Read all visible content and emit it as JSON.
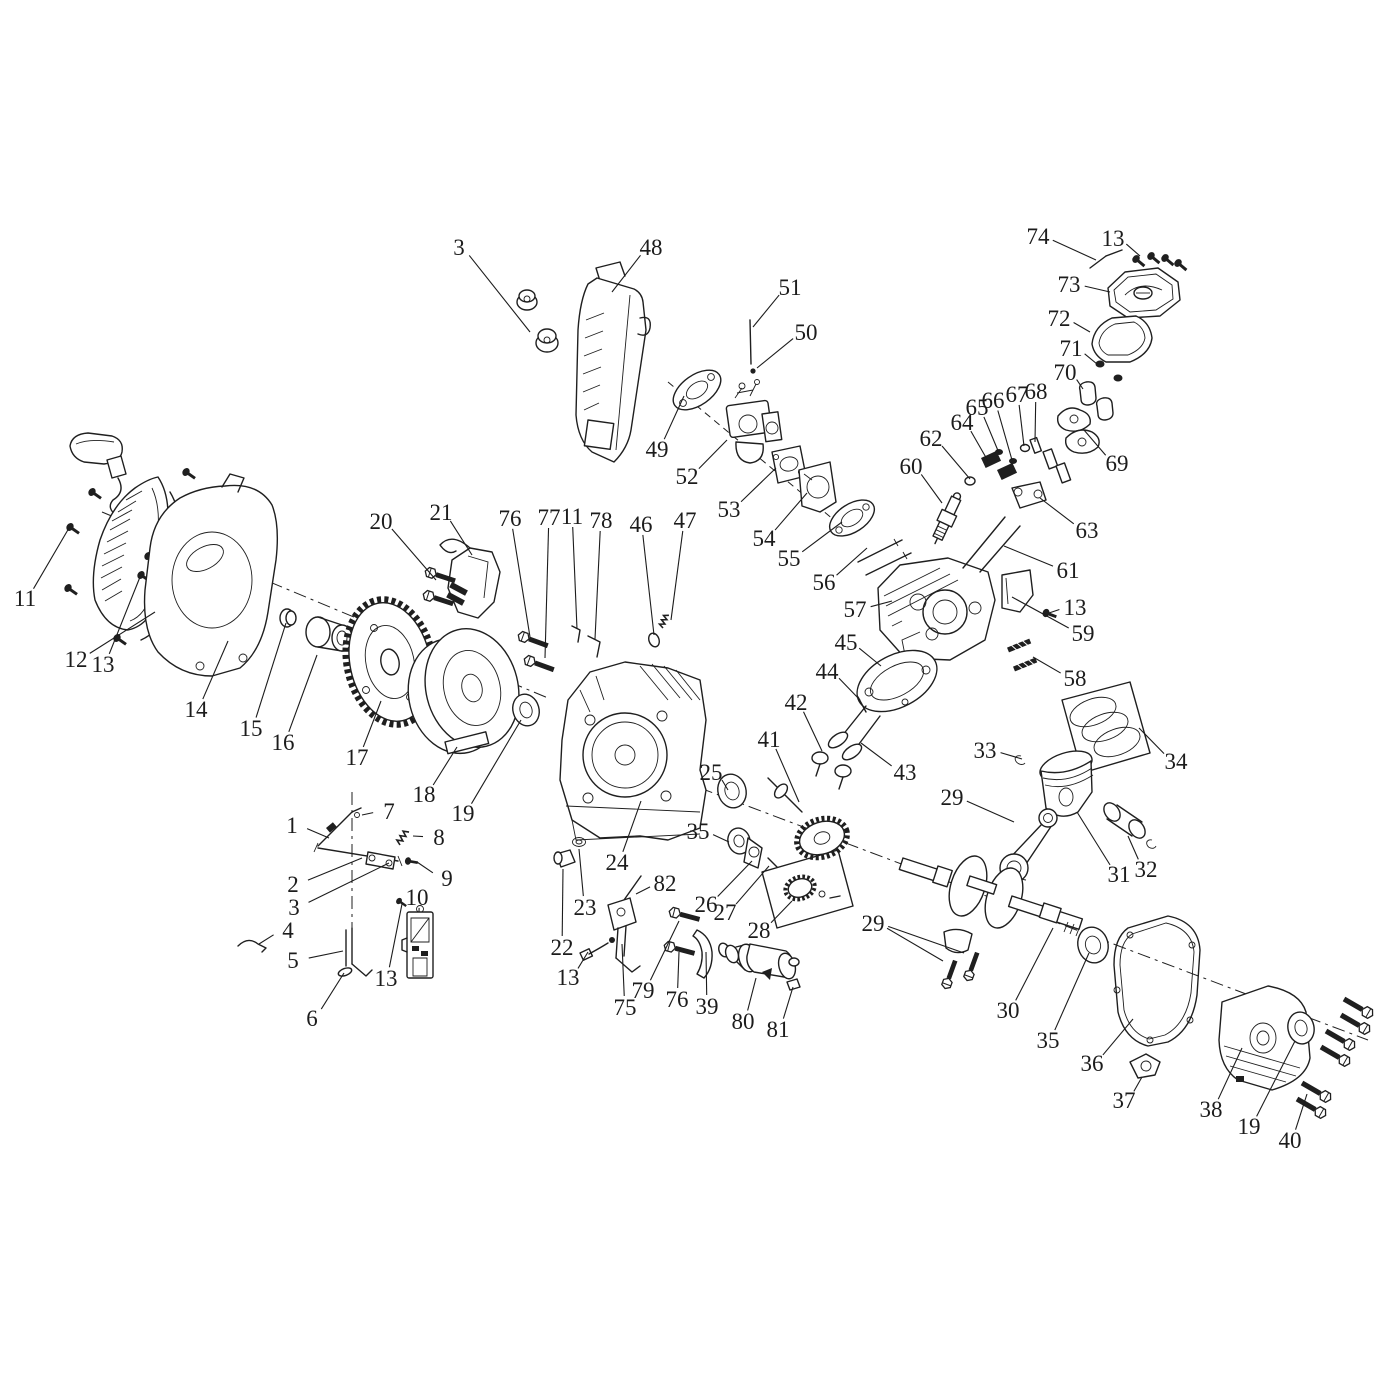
{
  "document": {
    "type": "exploded-parts-diagram",
    "subject": "small gasoline engine assembly",
    "background_color": "#ffffff",
    "line_color": "#1f1f1f",
    "canvas": {
      "width": 1377,
      "height": 1377
    }
  },
  "callouts": [
    {
      "n": "3",
      "x": 459,
      "y": 247,
      "tx": 530,
      "ty": 332
    },
    {
      "n": "48",
      "x": 651,
      "y": 247,
      "tx": 612,
      "ty": 292
    },
    {
      "n": "51",
      "x": 790,
      "y": 287,
      "tx": 753,
      "ty": 327
    },
    {
      "n": "50",
      "x": 806,
      "y": 332,
      "tx": 757,
      "ty": 368
    },
    {
      "n": "74",
      "x": 1038,
      "y": 236,
      "tx": 1096,
      "ty": 260
    },
    {
      "n": "13",
      "x": 1113,
      "y": 238,
      "tx": 1140,
      "ty": 256
    },
    {
      "n": "73",
      "x": 1069,
      "y": 284,
      "tx": 1110,
      "ty": 292
    },
    {
      "n": "72",
      "x": 1059,
      "y": 318,
      "tx": 1090,
      "ty": 332
    },
    {
      "n": "71",
      "x": 1071,
      "y": 348,
      "tx": 1097,
      "ty": 364
    },
    {
      "n": "70",
      "x": 1065,
      "y": 372,
      "tx": 1083,
      "ty": 389
    },
    {
      "n": "68",
      "x": 1036,
      "y": 391,
      "tx": 1035,
      "ty": 442
    },
    {
      "n": "67",
      "x": 1017,
      "y": 394,
      "tx": 1024,
      "ty": 446
    },
    {
      "n": "66",
      "x": 993,
      "y": 400,
      "tx": 1012,
      "ty": 460
    },
    {
      "n": "65",
      "x": 977,
      "y": 407,
      "tx": 999,
      "ty": 453
    },
    {
      "n": "64",
      "x": 962,
      "y": 422,
      "tx": 988,
      "ty": 461
    },
    {
      "n": "62",
      "x": 931,
      "y": 438,
      "tx": 970,
      "ty": 479
    },
    {
      "n": "60",
      "x": 911,
      "y": 466,
      "tx": 942,
      "ty": 503
    },
    {
      "n": "69",
      "x": 1117,
      "y": 463,
      "tx": 1084,
      "ty": 430
    },
    {
      "n": "63",
      "x": 1087,
      "y": 530,
      "tx": 1040,
      "ty": 498
    },
    {
      "n": "49",
      "x": 657,
      "y": 449,
      "tx": 684,
      "ty": 396
    },
    {
      "n": "52",
      "x": 687,
      "y": 476,
      "tx": 727,
      "ty": 440
    },
    {
      "n": "53",
      "x": 729,
      "y": 509,
      "tx": 776,
      "ty": 468
    },
    {
      "n": "54",
      "x": 764,
      "y": 538,
      "tx": 807,
      "ty": 493
    },
    {
      "n": "55",
      "x": 789,
      "y": 558,
      "tx": 842,
      "ty": 522
    },
    {
      "n": "56",
      "x": 824,
      "y": 582,
      "tx": 867,
      "ty": 548
    },
    {
      "n": "57",
      "x": 855,
      "y": 609,
      "tx": 892,
      "ty": 601
    },
    {
      "n": "61",
      "x": 1068,
      "y": 570,
      "tx": 1004,
      "ty": 546
    },
    {
      "n": "13",
      "x": 1075,
      "y": 607,
      "tx": 1049,
      "ty": 613
    },
    {
      "n": "59",
      "x": 1083,
      "y": 633,
      "tx": 1012,
      "ty": 597
    },
    {
      "n": "58",
      "x": 1075,
      "y": 678,
      "tx": 1033,
      "ty": 657
    },
    {
      "n": "45",
      "x": 846,
      "y": 642,
      "tx": 881,
      "ty": 666
    },
    {
      "n": "44",
      "x": 827,
      "y": 671,
      "tx": 860,
      "ty": 700
    },
    {
      "n": "42",
      "x": 796,
      "y": 702,
      "tx": 822,
      "ty": 751
    },
    {
      "n": "43",
      "x": 905,
      "y": 772,
      "tx": 861,
      "ty": 743
    },
    {
      "n": "34",
      "x": 1176,
      "y": 761,
      "tx": 1139,
      "ty": 728
    },
    {
      "n": "33",
      "x": 985,
      "y": 750,
      "tx": 1022,
      "ty": 759
    },
    {
      "n": "41",
      "x": 769,
      "y": 739,
      "tx": 799,
      "ty": 802
    },
    {
      "n": "25",
      "x": 711,
      "y": 772,
      "tx": 728,
      "ty": 790
    },
    {
      "n": "35",
      "x": 698,
      "y": 831,
      "tx": 729,
      "ty": 842
    },
    {
      "n": "29",
      "x": 952,
      "y": 797,
      "tx": 1014,
      "ty": 822
    },
    {
      "n": "31",
      "x": 1119,
      "y": 874,
      "tx": 1077,
      "ty": 812
    },
    {
      "n": "32",
      "x": 1146,
      "y": 869,
      "tx": 1128,
      "ty": 836
    },
    {
      "n": "26",
      "x": 706,
      "y": 904,
      "tx": 752,
      "ty": 861
    },
    {
      "n": "27",
      "x": 725,
      "y": 912,
      "tx": 769,
      "ty": 866
    },
    {
      "n": "28",
      "x": 759,
      "y": 930,
      "tx": 792,
      "ty": 901
    },
    {
      "n": "24",
      "x": 617,
      "y": 862,
      "tx": 641,
      "ty": 801
    },
    {
      "n": "22",
      "x": 562,
      "y": 947,
      "tx": 563,
      "ty": 869
    },
    {
      "n": "23",
      "x": 585,
      "y": 907,
      "tx": 579,
      "ty": 849
    },
    {
      "n": "82",
      "x": 665,
      "y": 883,
      "tx": 636,
      "ty": 894
    },
    {
      "n": "75",
      "x": 625,
      "y": 1007,
      "tx": 622,
      "ty": 944
    },
    {
      "n": "79",
      "x": 643,
      "y": 990,
      "tx": 679,
      "ty": 921
    },
    {
      "n": "76",
      "x": 677,
      "y": 999,
      "tx": 679,
      "ty": 952
    },
    {
      "n": "39",
      "x": 707,
      "y": 1006,
      "tx": 706,
      "ty": 952
    },
    {
      "n": "80",
      "x": 743,
      "y": 1021,
      "tx": 756,
      "ty": 978
    },
    {
      "n": "81",
      "x": 778,
      "y": 1029,
      "tx": 793,
      "ty": 987
    },
    {
      "n": "13",
      "x": 568,
      "y": 977,
      "tx": 588,
      "ty": 952
    },
    {
      "n": "29",
      "x": 873,
      "y": 923,
      "tx": 943,
      "ty": 961,
      "tx2": 964,
      "ty2": 953
    },
    {
      "n": "30",
      "x": 1008,
      "y": 1010,
      "tx": 1053,
      "ty": 928
    },
    {
      "n": "35",
      "x": 1048,
      "y": 1040,
      "tx": 1089,
      "ty": 953
    },
    {
      "n": "36",
      "x": 1092,
      "y": 1063,
      "tx": 1133,
      "ty": 1019
    },
    {
      "n": "37",
      "x": 1124,
      "y": 1100,
      "tx": 1142,
      "ty": 1077
    },
    {
      "n": "38",
      "x": 1211,
      "y": 1109,
      "tx": 1242,
      "ty": 1048
    },
    {
      "n": "19",
      "x": 1249,
      "y": 1126,
      "tx": 1295,
      "ty": 1041
    },
    {
      "n": "40",
      "x": 1290,
      "y": 1140,
      "tx": 1307,
      "ty": 1094
    },
    {
      "n": "11",
      "x": 25,
      "y": 598,
      "tx": 69,
      "ty": 528
    },
    {
      "n": "12",
      "x": 76,
      "y": 659,
      "tx": 155,
      "ty": 612
    },
    {
      "n": "13",
      "x": 103,
      "y": 664,
      "tx": 140,
      "ty": 577
    },
    {
      "n": "14",
      "x": 196,
      "y": 709,
      "tx": 228,
      "ty": 641
    },
    {
      "n": "15",
      "x": 251,
      "y": 728,
      "tx": 286,
      "ty": 623
    },
    {
      "n": "16",
      "x": 283,
      "y": 742,
      "tx": 317,
      "ty": 655
    },
    {
      "n": "17",
      "x": 357,
      "y": 757,
      "tx": 381,
      "ty": 701
    },
    {
      "n": "18",
      "x": 424,
      "y": 794,
      "tx": 457,
      "ty": 747
    },
    {
      "n": "19",
      "x": 463,
      "y": 813,
      "tx": 521,
      "ty": 720
    },
    {
      "n": "20",
      "x": 381,
      "y": 521,
      "tx": 436,
      "ty": 580
    },
    {
      "n": "21",
      "x": 441,
      "y": 512,
      "tx": 472,
      "ty": 555
    },
    {
      "n": "76",
      "x": 510,
      "y": 518,
      "tx": 530,
      "ty": 637
    },
    {
      "n": "77",
      "x": 549,
      "y": 517,
      "tx": 545,
      "ty": 658
    },
    {
      "n": "11",
      "x": 572,
      "y": 516,
      "tx": 577,
      "ty": 629
    },
    {
      "n": "78",
      "x": 601,
      "y": 520,
      "tx": 595,
      "ty": 639
    },
    {
      "n": "46",
      "x": 641,
      "y": 524,
      "tx": 654,
      "ty": 635
    },
    {
      "n": "47",
      "x": 685,
      "y": 520,
      "tx": 671,
      "ty": 620
    },
    {
      "n": "1",
      "x": 292,
      "y": 825,
      "tx": 329,
      "ty": 838
    },
    {
      "n": "7",
      "x": 389,
      "y": 811,
      "tx": 362,
      "ty": 815
    },
    {
      "n": "8",
      "x": 439,
      "y": 837,
      "tx": 413,
      "ty": 836
    },
    {
      "n": "2",
      "x": 293,
      "y": 884,
      "tx": 362,
      "ty": 858
    },
    {
      "n": "3",
      "x": 294,
      "y": 907,
      "tx": 389,
      "ty": 863
    },
    {
      "n": "9",
      "x": 447,
      "y": 878,
      "tx": 417,
      "ty": 862
    },
    {
      "n": "4",
      "x": 288,
      "y": 930,
      "tx": 259,
      "ty": 944
    },
    {
      "n": "5",
      "x": 293,
      "y": 960,
      "tx": 343,
      "ty": 951
    },
    {
      "n": "6",
      "x": 312,
      "y": 1018,
      "tx": 344,
      "ty": 973
    },
    {
      "n": "10",
      "x": 417,
      "y": 897,
      "tx": 419,
      "ty": 912
    },
    {
      "n": "13",
      "x": 386,
      "y": 978,
      "tx": 402,
      "ty": 904
    }
  ]
}
